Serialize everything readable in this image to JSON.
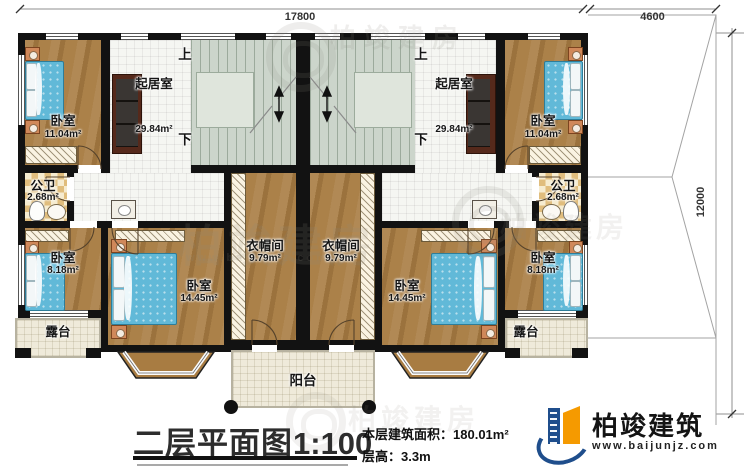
{
  "dimensions": {
    "top_left": "17800",
    "top_right": "4600",
    "right": "12000"
  },
  "stairs": {
    "up": "上",
    "down": "下"
  },
  "rooms": {
    "living_left": {
      "name": "起居室",
      "area": "29.84m²"
    },
    "living_right": {
      "name": "起居室",
      "area": "29.84m²"
    },
    "bedroom_tl": {
      "name": "卧室",
      "area": "11.04m²"
    },
    "bedroom_tr": {
      "name": "卧室",
      "area": "11.04m²"
    },
    "bath_left": {
      "name": "公卫",
      "area": "2.68m²"
    },
    "bath_right": {
      "name": "公卫",
      "area": "2.68m²"
    },
    "bedroom_small_left": {
      "name": "卧室",
      "area": "8.18m²"
    },
    "bedroom_small_right": {
      "name": "卧室",
      "area": "8.18m²"
    },
    "bedroom_big_left": {
      "name": "卧室",
      "area": "14.45m²"
    },
    "bedroom_big_right": {
      "name": "卧室",
      "area": "14.45m²"
    },
    "cloak_left": {
      "name": "衣帽间",
      "area": "9.79m²"
    },
    "cloak_right": {
      "name": "衣帽间",
      "area": "9.79m²"
    },
    "terrace_left": {
      "name": "露台"
    },
    "terrace_right": {
      "name": "露台"
    },
    "balcony": {
      "name": "阳台"
    }
  },
  "footer": {
    "title": "二层平面图",
    "scale": "1:100",
    "area_label": "本层建筑面积：",
    "area_value": "180.01m²",
    "height_label": "层高：",
    "height_value": "3.3m"
  },
  "brand": {
    "name": "柏竣建筑",
    "url": "www.baijunjz.com",
    "blue": "#1f4e8c",
    "orange": "#f59a00"
  },
  "watermark": {
    "text": "柏竣建房",
    "url": "www.baijunjz.com"
  }
}
